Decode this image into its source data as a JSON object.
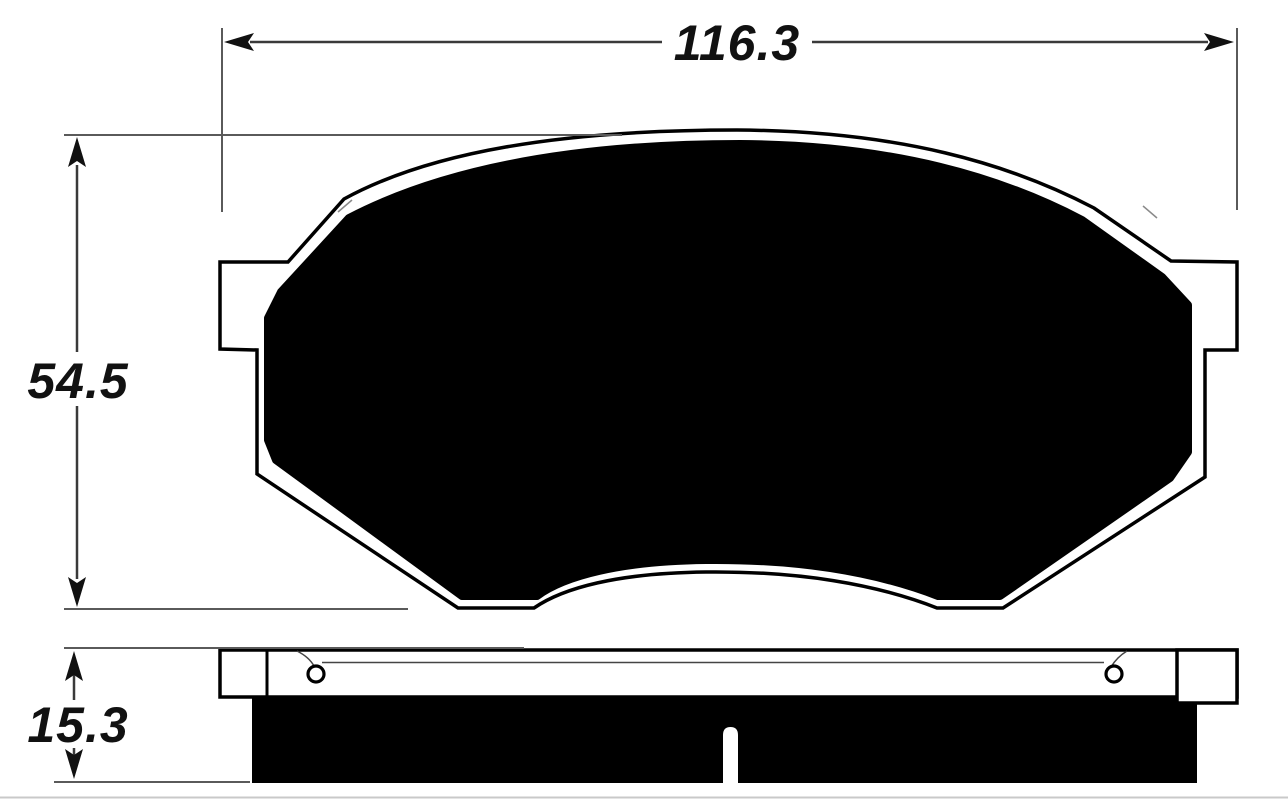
{
  "drawing": {
    "kind": "brake-pad-technical-drawing",
    "dimensions": {
      "width": {
        "label": "116.3"
      },
      "height": {
        "label": "54.5"
      },
      "thickness": {
        "label": "15.3"
      }
    },
    "views": {
      "face_view": {
        "parts": [
          "backing-plate-outline",
          "friction-material",
          "left-ear-tab",
          "right-ear-tab"
        ]
      },
      "edge_view": {
        "parts": [
          "backing-plate-strip",
          "left-rivet-hole",
          "right-rivet-hole",
          "friction-strip",
          "center-wear-slot"
        ]
      }
    },
    "colors": {
      "ink": "#111111",
      "dim_line": "#3a3a3a",
      "ext_line": "#5a5a5a",
      "fill": "#000000",
      "background": "#ffffff",
      "edge_shadow": "#c9c9c9"
    }
  }
}
